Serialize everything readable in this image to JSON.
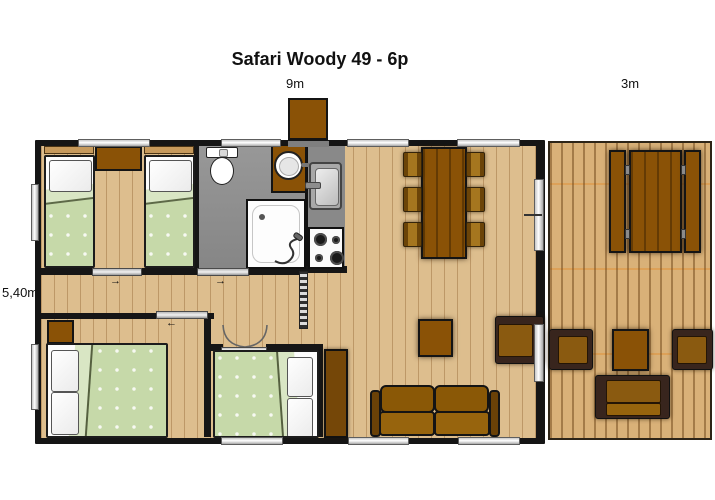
{
  "title": "Safari Woody 49 - 6p",
  "labels": {
    "building_width": "9m",
    "terrace_width": "3m",
    "building_depth": "5,40m"
  },
  "colors": {
    "wall": "#161616",
    "interior_floor": "#ddbe8e",
    "terrace_deck": "#d9b178",
    "furniture_brown": "#8a5206",
    "dark_frame_brown": "#38251d",
    "cushion_brown": "#8a5a10",
    "bed_green": "#c6d9a9",
    "bathroom_gray": "#909090",
    "window_white": "#ffffff"
  },
  "rooms": [
    "twin-bedroom",
    "bathroom",
    "kitchen",
    "dining-area",
    "living-area",
    "hallway",
    "double-bedroom-1",
    "double-bedroom-2",
    "terrace"
  ]
}
